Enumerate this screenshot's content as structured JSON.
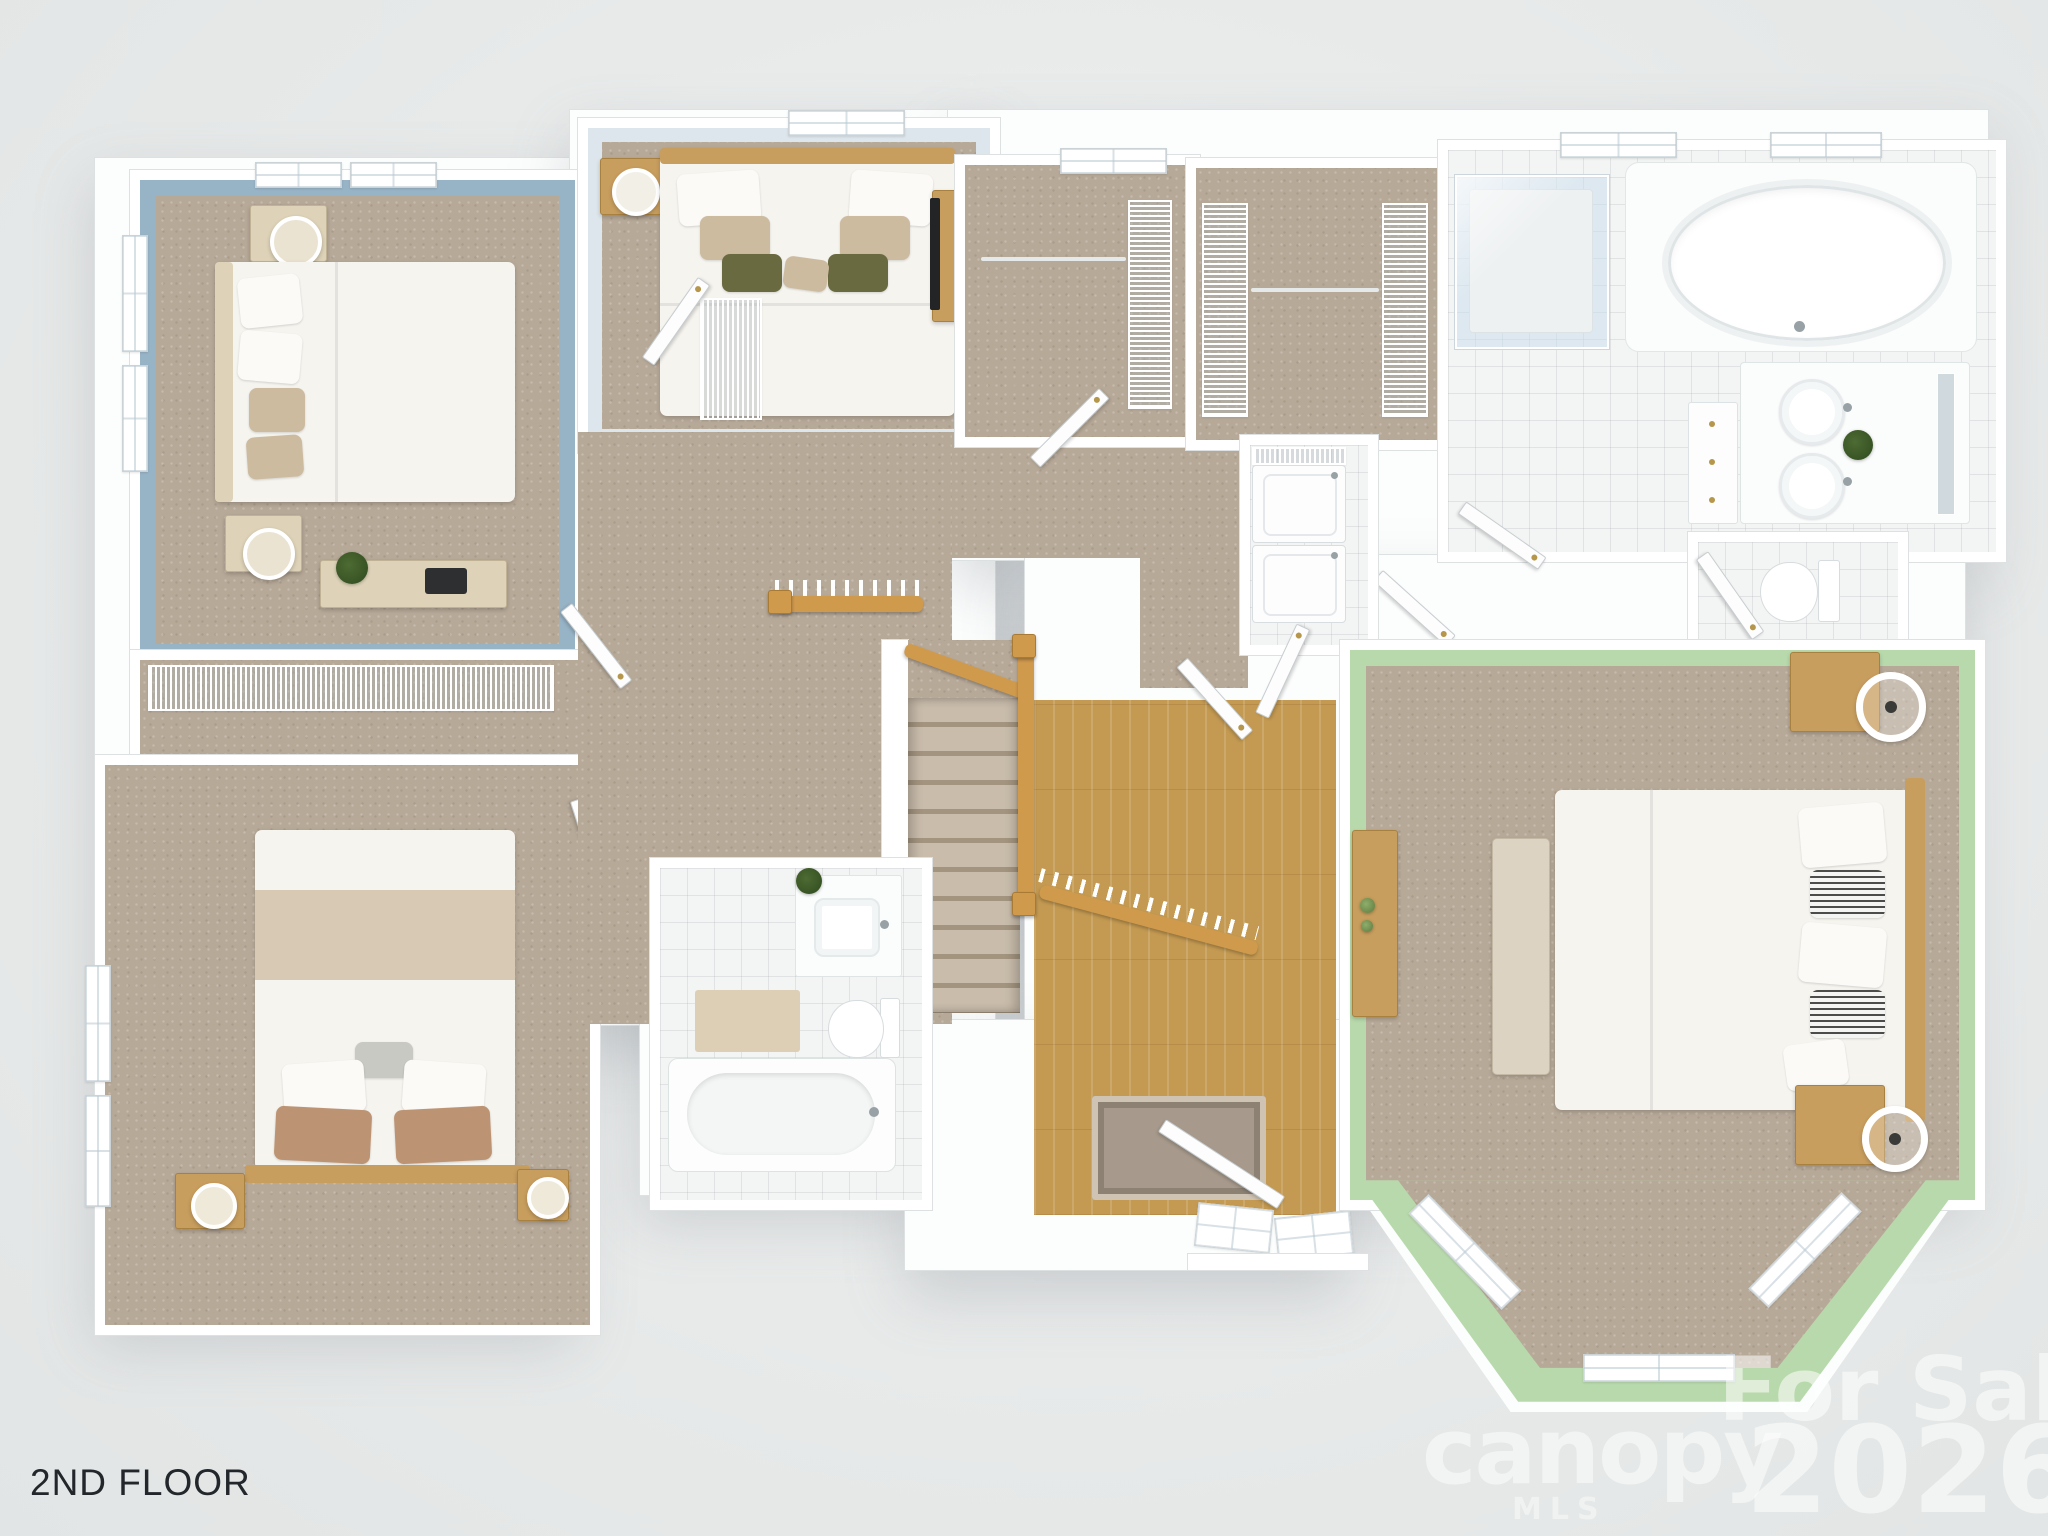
{
  "floor_label": {
    "text": "2ND FLOOR"
  },
  "watermark": {
    "brand": "canopy",
    "brand_subtitle": "MLS",
    "listing_status": "For Sale",
    "year": "2026",
    "color": "#ffffff"
  },
  "palette": {
    "bg": "#e8eaea",
    "bg2": "#f0f2f2",
    "slab": "#fcfdfd",
    "wallline": "#dde1e2",
    "carpet": "#b7a998",
    "tile": "#f3f4f4",
    "wood": "#c49a52",
    "oak": "#d09a4d",
    "blue": "#97b3c6",
    "lightblue": "#dde6ec",
    "green": "#b8d9ac",
    "cream": "#ded3b8",
    "woodfurn": "#c89e5e",
    "tanpillow": "#cdbba0",
    "label": "#23272b"
  },
  "rooms": [
    {
      "id": "bedroom-top-left",
      "wall_color": "#97b3c6",
      "floor": "carpet"
    },
    {
      "id": "bedroom-top-middle",
      "wall_color": "#dde6ec",
      "floor": "carpet"
    },
    {
      "id": "bedroom-bottom-left",
      "wall_color": "#ffffff",
      "floor": "carpet"
    },
    {
      "id": "master-bedroom",
      "wall_color": "#b8d9ac",
      "floor": "carpet",
      "feature": "bay-window"
    },
    {
      "id": "master-bathroom",
      "floor": "tile",
      "fixtures": [
        "garden-tub",
        "glass-shower",
        "double-vanity",
        "toilet"
      ]
    },
    {
      "id": "hall-bathroom",
      "floor": "tile",
      "fixtures": [
        "bathtub",
        "toilet",
        "vanity"
      ]
    },
    {
      "id": "laundry-closet",
      "appliances": [
        "washer",
        "dryer"
      ]
    },
    {
      "id": "walk-in-closet-a",
      "floor": "carpet"
    },
    {
      "id": "walk-in-closet-b",
      "floor": "carpet"
    },
    {
      "id": "hallway-stairs",
      "floor": "carpet",
      "feature": "oak-railing-over-foyer"
    }
  ]
}
